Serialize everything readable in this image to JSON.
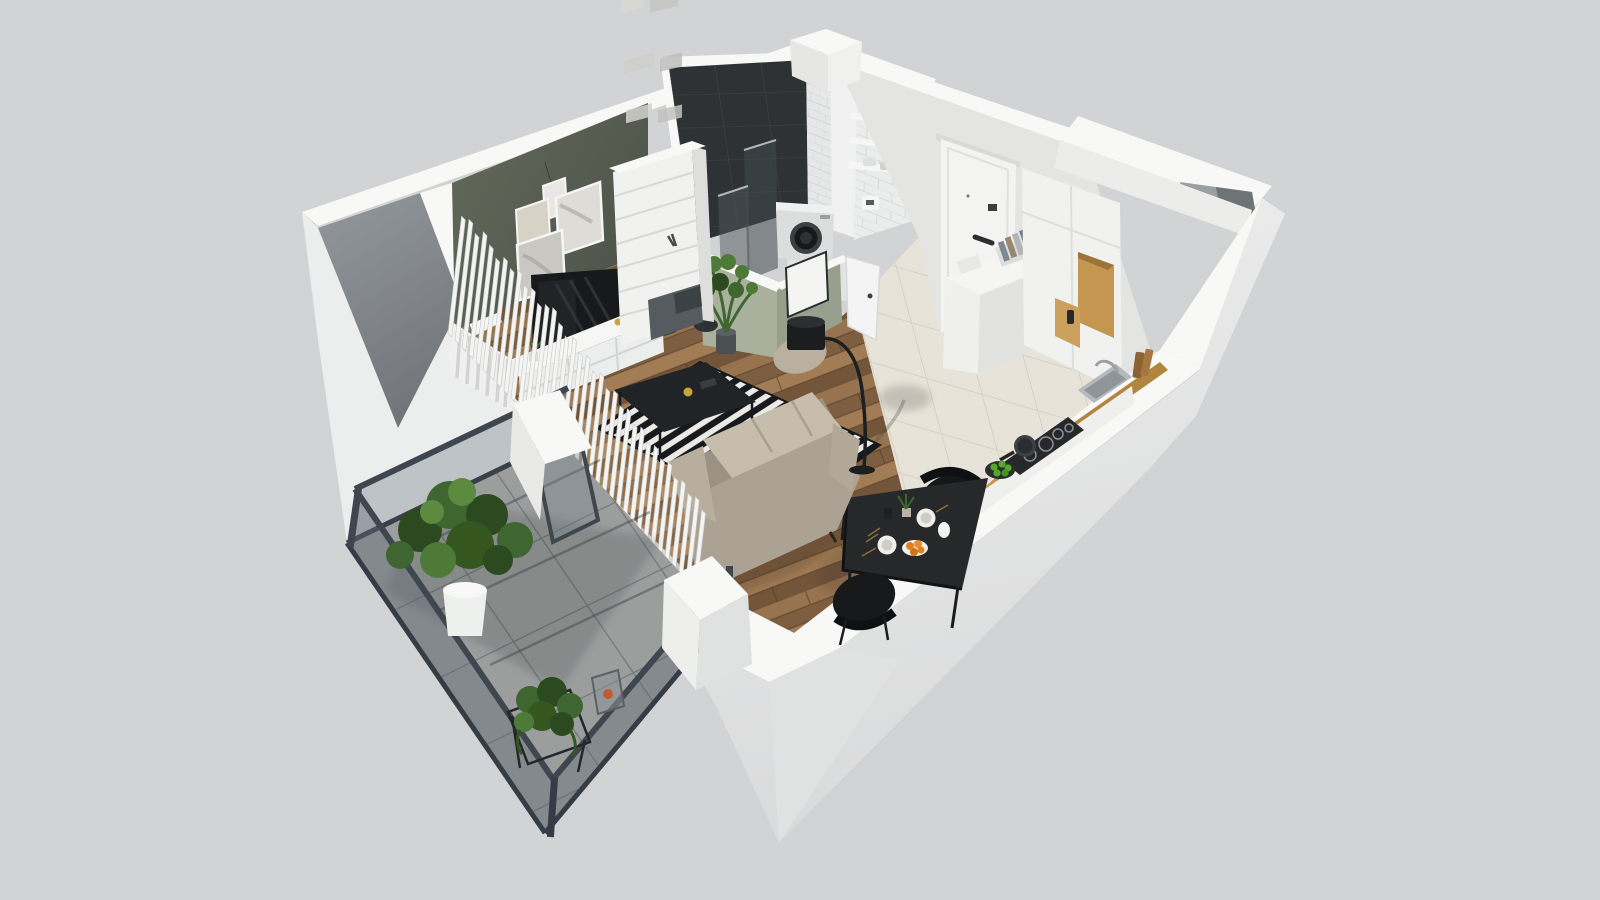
{
  "scene": {
    "type": "3d-floorplan-render",
    "view": "isometric dollhouse cutaway, bird's-eye",
    "style": "white cut walls on neutral gray background",
    "background": "#d2d3d4"
  },
  "apartment": {
    "rooms": [
      {
        "id": "living-room",
        "name": "Living room",
        "floor": "herringbone wood",
        "accent_wall": "olive green",
        "furniture": [
          "wall-pictures x4",
          "pendant-bulb",
          "wall-tv",
          "tv-metal-frame",
          "white-media-console",
          "tall-white-bookshelf",
          "beige-sofa",
          "black-coffee-table",
          "black-white-striped-rug",
          "arc-floor-lamp",
          "beige-pouf-with-black-lamp",
          "white-radiator",
          "potted-plant-on-stool"
        ]
      },
      {
        "id": "bathroom",
        "name": "Bathroom",
        "walls": "dark graphite tile + white subway tile",
        "furniture": [
          "glass-shower-screens",
          "washing-machine",
          "tiled-duct-column",
          "wall-shelves x3",
          "shelf-plant",
          "towels",
          "flush-panel",
          "open-white-door",
          "sage-half-walls",
          "framed-board"
        ]
      },
      {
        "id": "hallway",
        "name": "Hallway",
        "floor": "beige gloss tile",
        "furniture": [
          "entry-door-white",
          "white-sideboard",
          "letter-rack",
          "book-stack",
          "tall-white-wardrobe",
          "wood-lined-niche x2"
        ]
      },
      {
        "id": "kitchen",
        "name": "Kitchen",
        "floor": "beige gloss tile",
        "furniture": [
          "oak-worktop",
          "induction-hob",
          "frying-pan",
          "plate-of-green-apples",
          "steel-sink",
          "faucet",
          "cutting-boards",
          "tall-cabinet-column",
          "service-shaft"
        ]
      },
      {
        "id": "dining-area",
        "name": "Dining area",
        "furniture": [
          "black-dining-table",
          "black-chair x2",
          "dinner-plates x2",
          "orange-fruit-plate",
          "table-plant",
          "white-jug",
          "gold-cutlery"
        ]
      },
      {
        "id": "balcony",
        "name": "Balcony",
        "floor": "large gray tiles",
        "railing": "graphite steel + glass",
        "furniture": [
          "large-plant-white-pot",
          "ivy-plant-black-stand",
          "candle-lantern",
          "open-glass-door"
        ]
      }
    ]
  },
  "palette": {
    "bg": "#d2d3d4",
    "wallTop": "#f8f8f7",
    "wallFace": "#e9e9e8",
    "wallShade": "#d8d9da",
    "leftWallGray": "#8e9397",
    "leftWallGrayDark": "#75797d",
    "olive": "#5d6355",
    "oliveDark": "#4d5347",
    "sage": "#a9b19d",
    "sageDark": "#96a08c",
    "darkTile": "#2e3234",
    "darkTileLine": "#3d4244",
    "subway": "#ebedec",
    "subwayLine": "#d8dbda",
    "wood": "#8d6a4b",
    "tileFloor": "#e8e3d8",
    "tileGrout": "#d5cfc2",
    "balconyTile": "#9b9e9d",
    "balconyGrout": "#74787a",
    "railing": "#3f4650",
    "glassTint": "#6b7682",
    "sofa": "#ac younger",
    "sofaBody": "#aca293",
    "sofaLight": "#c7bdac",
    "sofaDark": "#857c6e",
    "rugDark": "#17191c",
    "rugLight": "#eceae6",
    "black": "#1d1f21",
    "consoleWhite": "#f2f2f1",
    "cabinetWood": "#c5964f",
    "doorWhite": "#f3f3f2",
    "washer": "#dcdedd",
    "appleGreen": "#54a82c",
    "orange": "#e2801f",
    "plantDark": "#2c4a20",
    "plantMid": "#3f6630",
    "plantLight": "#5c8a3e",
    "potWhite": "#eef0ee",
    "potDark": "#34383b",
    "gold": "#8a6d3a",
    "candleYellow": "#c8a43a"
  }
}
